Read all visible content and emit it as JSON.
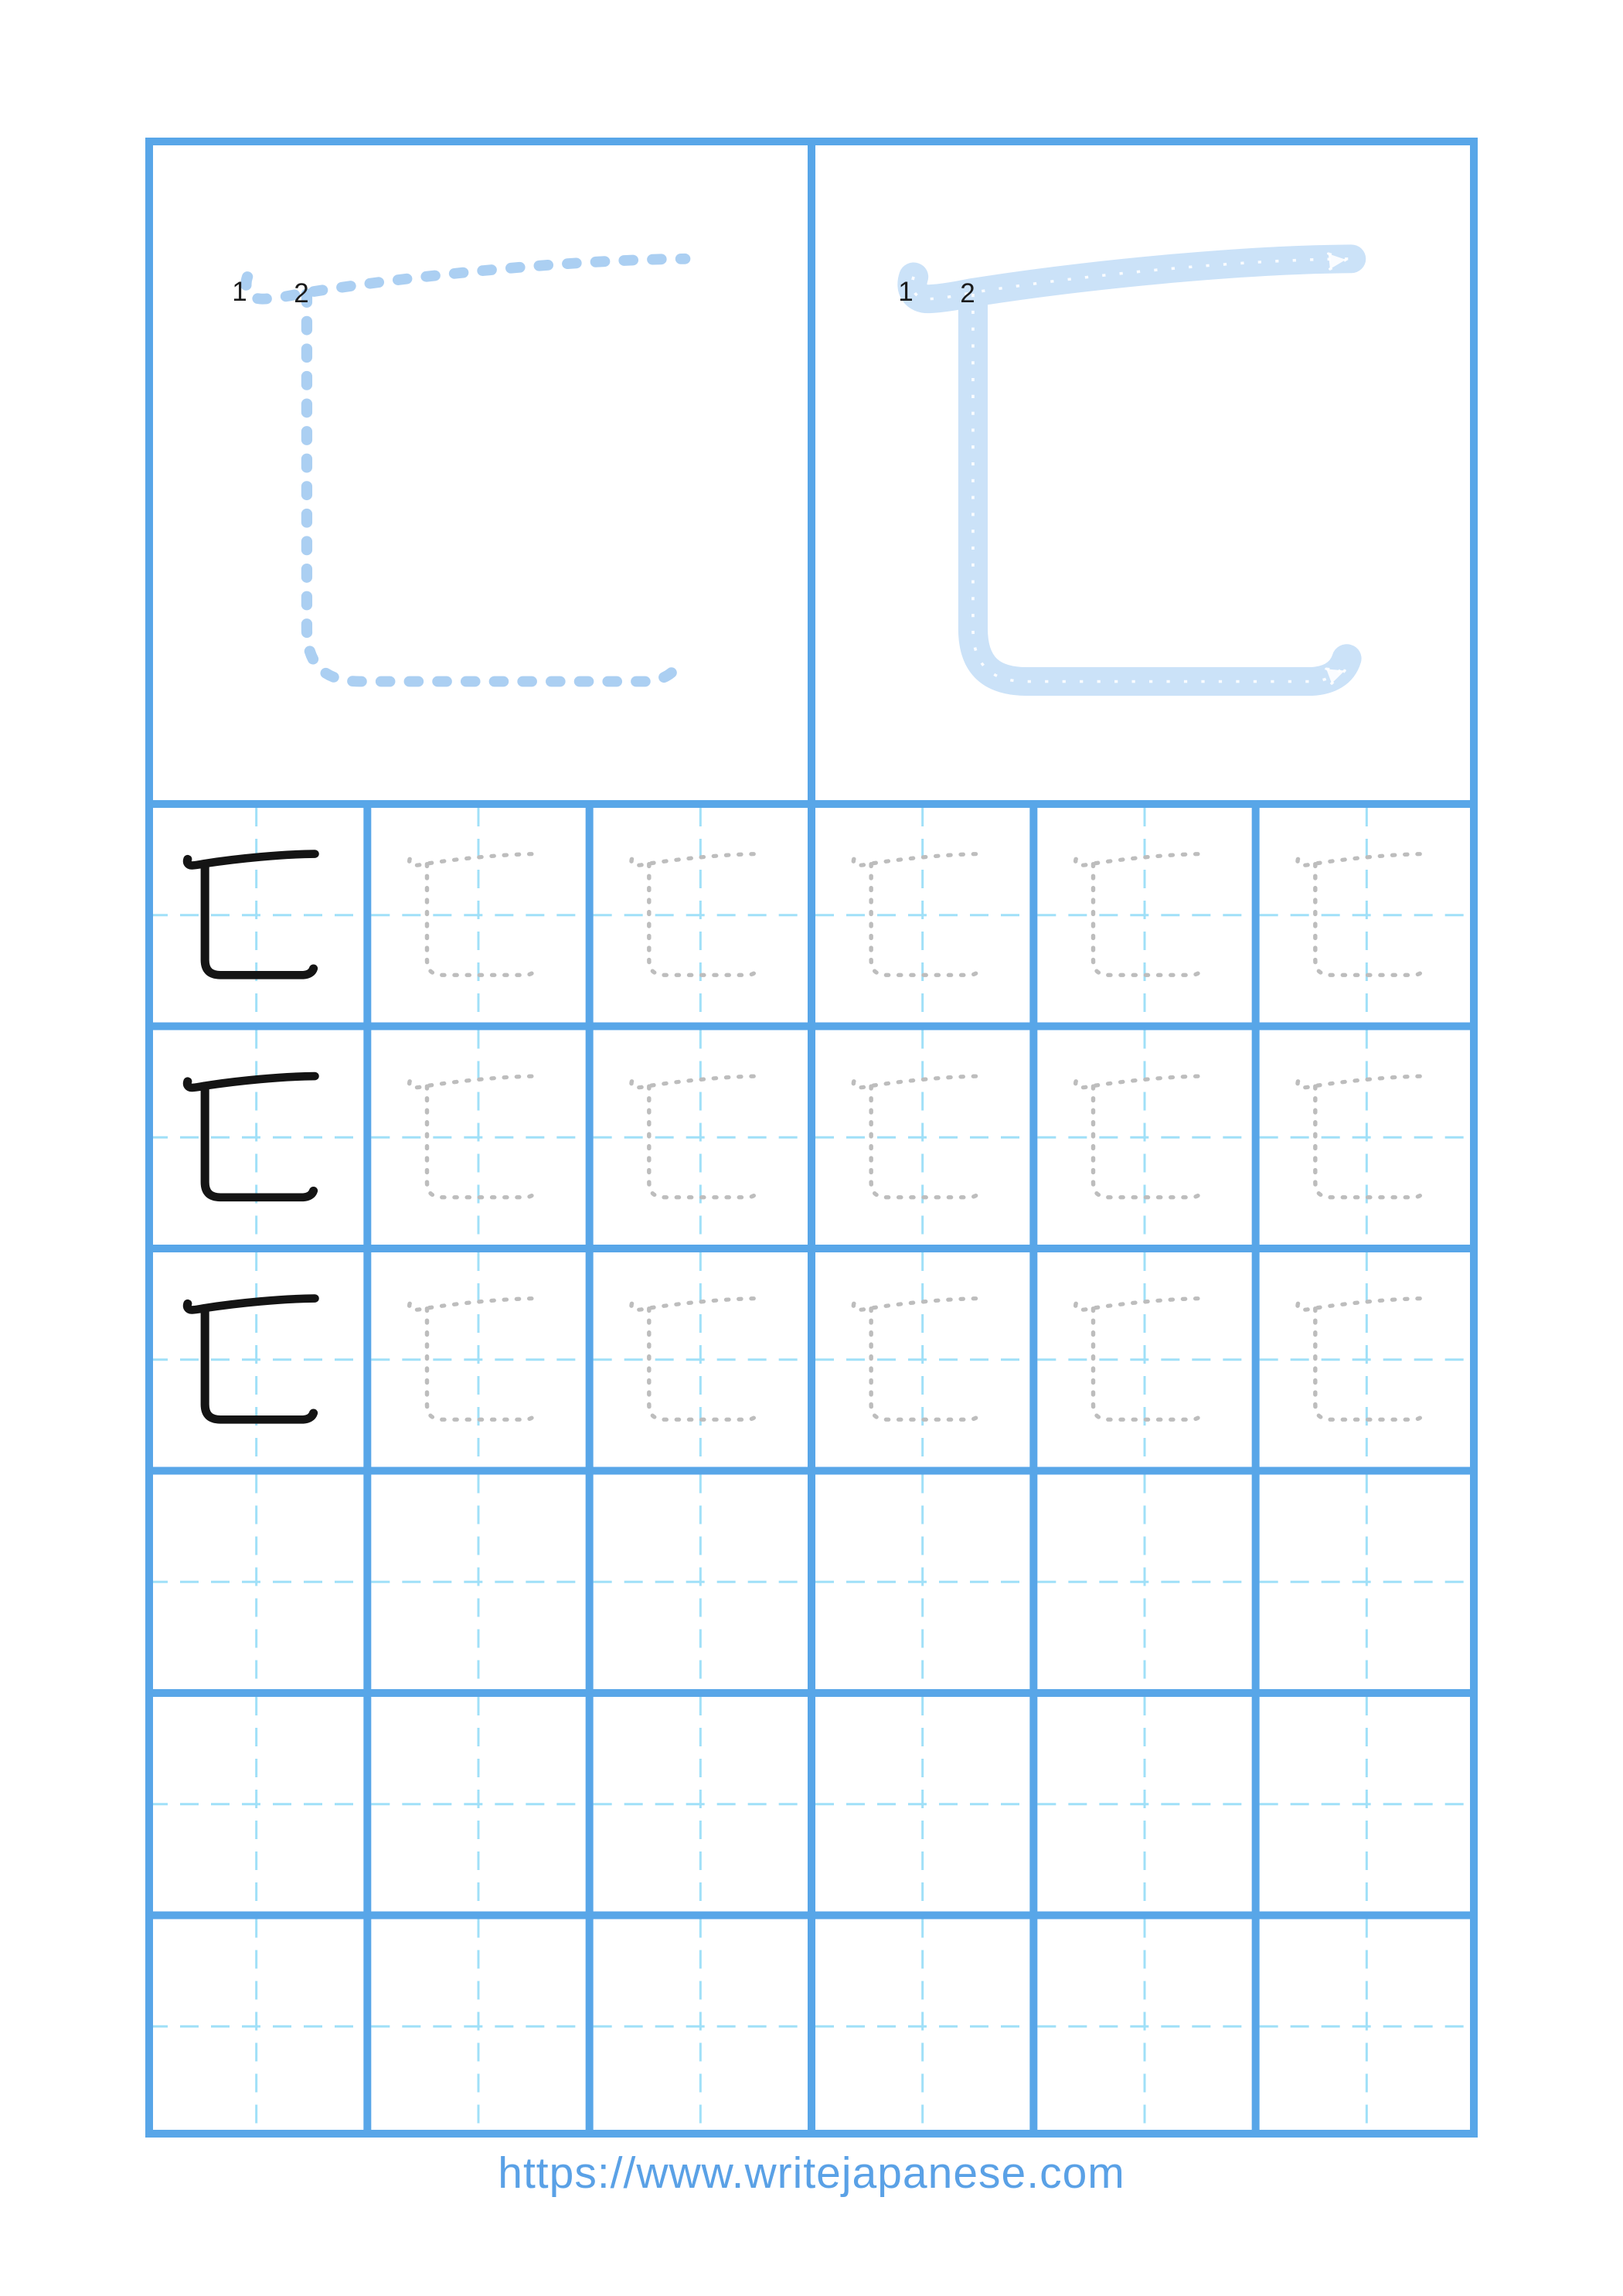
{
  "footer": {
    "url": "https://www.writejapanese.com"
  },
  "labels": {
    "stroke1": "1",
    "stroke2": "2"
  },
  "colors": {
    "frame_blue": "#58a6e8",
    "guide_cyan": "#a0e0f8",
    "trace_dash_blue": "#abcff2",
    "trace_band_blue": "#cbe2f8",
    "trace_centerline_white": "rgba(255,255,255,0.9)",
    "practice_gray": "#bdbdbd",
    "ink_black": "#141414",
    "label_black": "#1b1b1b",
    "url_blue": "#5aa1e6"
  },
  "grid": {
    "columns": 6,
    "rows": 6,
    "example_rows": 3,
    "example_column_index": 0
  },
  "character": {
    "stroke_count": 2,
    "stroke_numbers": [
      "1",
      "2"
    ]
  }
}
